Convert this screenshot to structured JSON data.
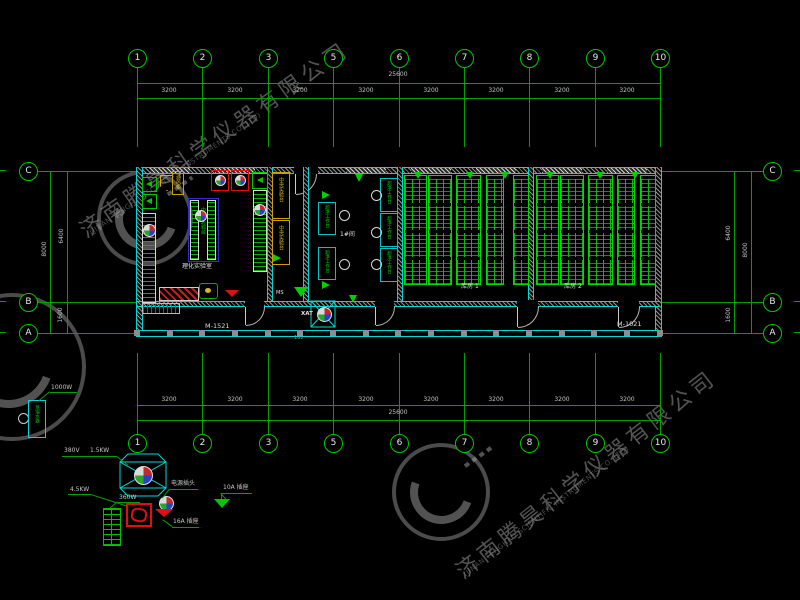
{
  "colors": {
    "grid_green": "#00A000",
    "wall_cyan": "#00D8D8",
    "rack_green": "#00DC00",
    "bench_blue": "#2F2FD0",
    "hood_red": "#E01010",
    "bench_yellow": "#C8A300",
    "text_white": "#E3E3E3",
    "watermark_gray": "#989898"
  },
  "grid": {
    "top_bubbles": [
      "1",
      "2",
      "3",
      "5",
      "6",
      "7",
      "8",
      "9",
      "10"
    ],
    "bottom_bubbles": [
      "1",
      "2",
      "3",
      "5",
      "6",
      "7",
      "8",
      "9",
      "10"
    ],
    "left_bubbles": [
      "C",
      "B",
      "A"
    ],
    "right_bubbles": [
      "C",
      "B",
      "A"
    ],
    "top_dims": {
      "total": "25600",
      "segments": [
        "3200",
        "3200",
        "3200",
        "3200",
        "3200",
        "3200",
        "3200",
        "3200"
      ]
    },
    "bottom_dims": {
      "total": "25600",
      "segments": [
        "3200",
        "3200",
        "3200",
        "3200",
        "3200",
        "3200",
        "3200",
        "3200"
      ]
    },
    "left_dims": {
      "upper": "6400",
      "total": "8000",
      "lower": "1600"
    },
    "right_dims": {
      "upper": "6400",
      "total": "8000",
      "lower": "1600"
    }
  },
  "plan": {
    "door_left": "M-1521",
    "door_right": "M-1021",
    "room1": {
      "label": "理化实验室",
      "central_bench": "中央实验台",
      "fume_hood": "通风柜"
    },
    "room2": {
      "bench_upper": "中央实验台",
      "bench_lower": "中央实验台",
      "ms_tag": "MS"
    },
    "mid_room": {
      "label": "1#间",
      "bench": "超净工作台",
      "equipment_tag": "XAT",
      "note": "162"
    },
    "storage1": {
      "label": "库房 1"
    },
    "storage2": {
      "label": "库房 2"
    }
  },
  "legend": {
    "distiller": {
      "power": "1000W",
      "name": "蒸馏水器"
    },
    "fan_unit": {
      "voltage": "380V",
      "power": "1.5KW"
    },
    "heater": {
      "power": "4.5KW"
    },
    "grille": {
      "power": "360W"
    },
    "plug": {
      "label": "电源插头"
    },
    "socket_16a": {
      "label": "16A 插座"
    },
    "socket_10a": {
      "label": "10A 插座"
    }
  },
  "watermark": {
    "cn": "济南腾昊科学仪器有限公司",
    "en": "(JINAN TENGHAO SCIENTIFIC INSTRUMENTS CO.,LTD)"
  }
}
